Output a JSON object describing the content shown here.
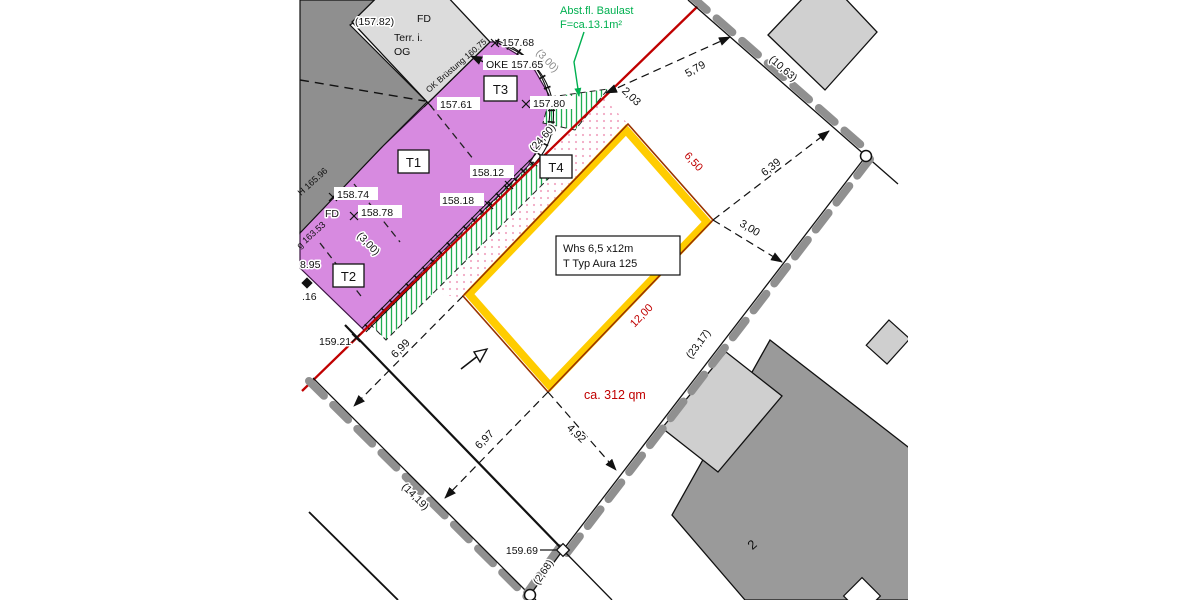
{
  "labels": {
    "planned1": "Whs  6,5 x12m",
    "planned2": "T Typ Aura 125",
    "area": "ca. 312 qm",
    "neighbor": "2",
    "note1": "Abst.fl. Baulast",
    "note2": "F=ca.13.1m²"
  },
  "dims": {
    "d203": "2,03",
    "d579": "5,79",
    "d639": "6,39",
    "d300": "3,00",
    "d699": "6,99",
    "d697": "6,97",
    "d492": "4,92",
    "d1063": "(10,63)",
    "d2317": "(23,17)",
    "d1419": "(14,19)",
    "d268": "(2,68)",
    "d2460": "(24,60)",
    "d300a": "(3,00)",
    "d300b": "(3,00)",
    "d650": "6,50",
    "d1200": "12,00"
  },
  "elev": {
    "e15768": "157.68",
    "oke": "OKE 157.65",
    "e15761": "157.61",
    "e15780": "157.80",
    "e15812": "158.12",
    "e15818": "158.18",
    "e15874": "158.74",
    "e15878": "158.78",
    "e15895": "8.95",
    "e16": ".16",
    "e15921": "159.21",
    "e15969": "159.69",
    "e15782": "(157.82)",
    "bruestung": "OK Brüstung 160.75",
    "h16596": "H 165.96",
    "g16353": "g 163.53"
  },
  "rooms": {
    "t1": "T1",
    "t2": "T2",
    "t3": "T3",
    "t4": "T4"
  },
  "misc": {
    "fd1": "FD",
    "fd2": "FD",
    "terr": "Terr. i.",
    "og": "OG"
  },
  "colors": {
    "red_line": "#c00000",
    "green": "#00b050",
    "yellow": "#ffcc00",
    "building_edge": "#993300",
    "purple": "#d78ae0",
    "boundary_gray": "#909090",
    "pink_dots": "#f2a9c4"
  }
}
